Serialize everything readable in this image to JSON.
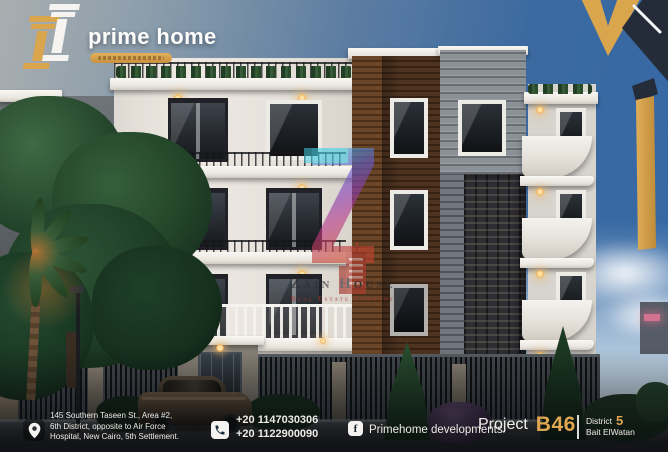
{
  "header": {
    "logo": {
      "brand": "prime home"
    }
  },
  "watermark": {
    "letter": "Z",
    "company": "Zain House",
    "tagline": "Real Estate Company"
  },
  "footer": {
    "address": {
      "lines": [
        "145 Southern Taseen St., Area #2,",
        "6th District, opposite to Air Force",
        "Hospital, New Cairo, 5th Settlement."
      ]
    },
    "phone": {
      "numbers": [
        "+20 1147030306",
        "+20 1122900090"
      ]
    },
    "facebook": {
      "icon_letter": "f",
      "label": "Primehome developments"
    },
    "project": {
      "label": "Project",
      "code": "B46",
      "district_label": "District",
      "district_number": "5",
      "district_area": "Bait ElWatan"
    }
  },
  "colors": {
    "gold": "#d9a64e",
    "navy": "#242c3a",
    "accent_red": "#b23a30",
    "accent_cyan": "#45d4e8"
  }
}
